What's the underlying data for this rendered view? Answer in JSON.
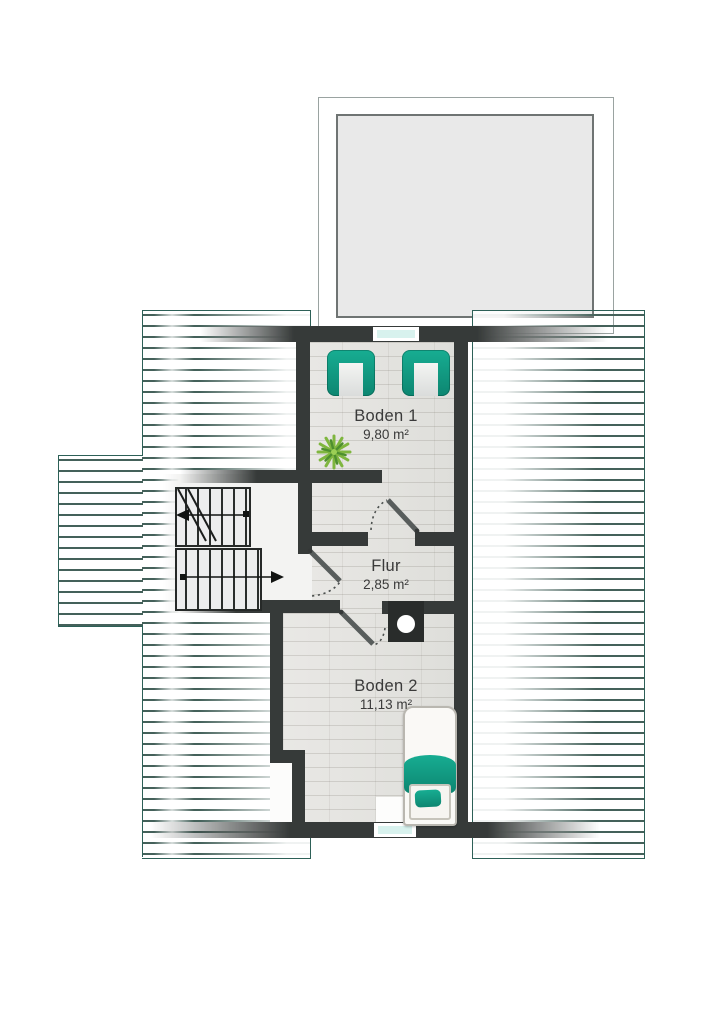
{
  "plan_type": "attic-floor-plan",
  "rooms": [
    {
      "id": "boden1",
      "name": "Boden 1",
      "area": "9,80 m²"
    },
    {
      "id": "flur",
      "name": "Flur",
      "area": "2,85 m²"
    },
    {
      "id": "boden2",
      "name": "Boden 2",
      "area": "11,13 m²"
    }
  ],
  "features": {
    "dormer": "roof dormer / terrace outline at top, gray filled",
    "stairs": {
      "flights": 2,
      "upper_arrow": "left",
      "lower_arrow": "right",
      "cut_line": true
    },
    "doors": 3,
    "windows": 2,
    "chimney": "black block with white circular flue between Flur and Boden 2",
    "roof_hatching": "horizontal dark-teal lines on left and right roof slopes with left bump-out"
  },
  "furniture": [
    {
      "name": "armchair",
      "room": "Boden 1",
      "color": "teal"
    },
    {
      "name": "armchair",
      "room": "Boden 1",
      "color": "teal"
    },
    {
      "name": "plant",
      "room": "Boden 1",
      "color": "green"
    },
    {
      "name": "single-bed",
      "room": "Boden 2",
      "color": "white-teal"
    }
  ],
  "colors": {
    "wall": "#363a39",
    "hatch_line": "#44615a",
    "hatch_border": "#2d6057",
    "teal": "#17ad92",
    "teal_dark": "#0d8671",
    "window_pane": "#d8f2ee",
    "floor": "#e5e4e1",
    "dormer_fill": "#e9e9e9",
    "stair_floor": "#f3f3f2",
    "label_text": "#3a3a3a",
    "plant_green": "#7fb63f",
    "plant_green_dark": "#4e8f2f"
  }
}
